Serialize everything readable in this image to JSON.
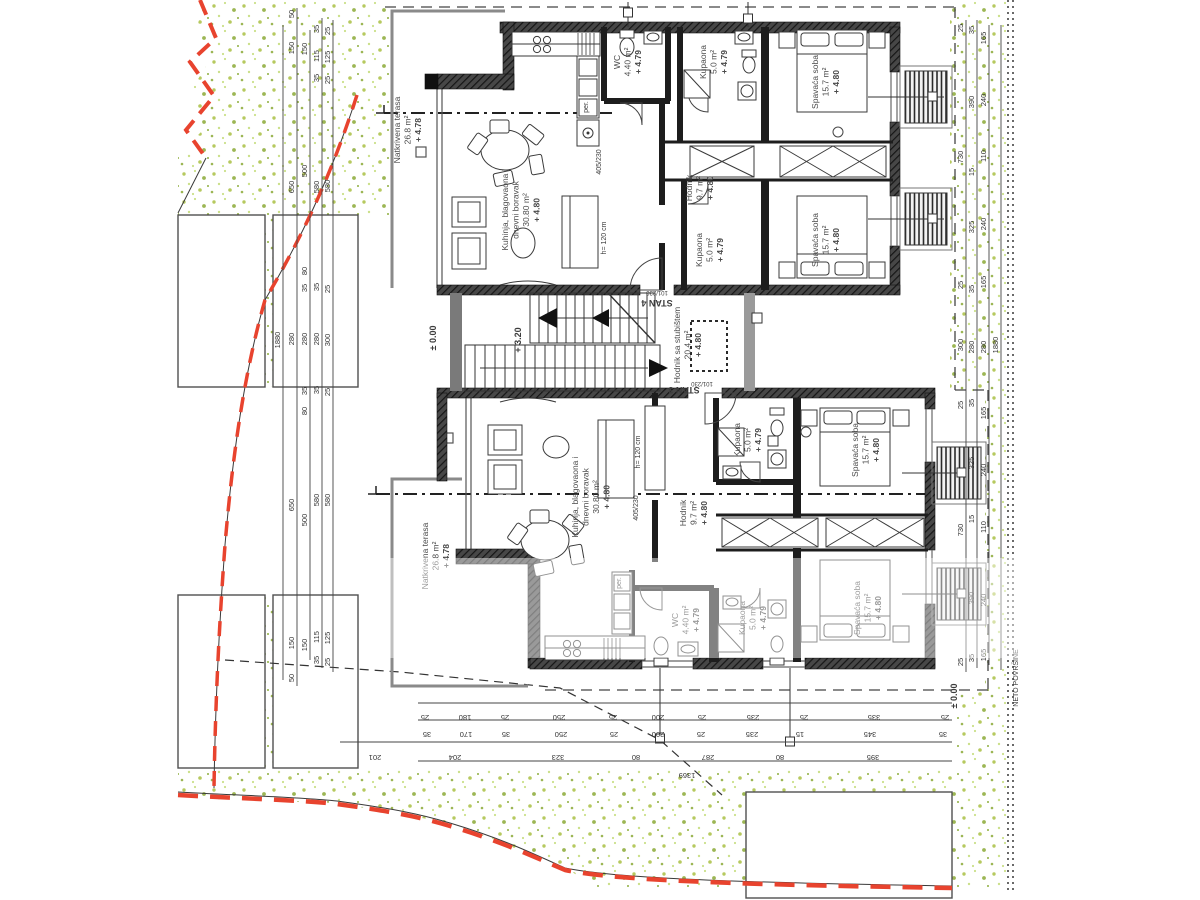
{
  "drawing": {
    "type": "architectural-floor-plan",
    "net_area_label": "NETO POVRŠINE",
    "boundary_color": "#e8432e",
    "grass_colors": [
      "#b6c95f",
      "#cbe08a",
      "#8fae3e"
    ]
  },
  "units": [
    {
      "id": "stan-4",
      "label": "STAN 4"
    },
    {
      "id": "stan-3",
      "label": "STAN 3"
    }
  ],
  "stan_labels": [
    {
      "text": "STAN 4",
      "x": 657,
      "y": 300
    },
    {
      "text": "STAN 3",
      "x": 684,
      "y": 387
    }
  ],
  "rooms": [
    {
      "lines": [
        "Natkrivena terasa",
        "26.8 m²",
        "+ 4.78"
      ],
      "x": 400,
      "y": 130
    },
    {
      "lines": [
        "Kuhinja, blagovaona i",
        "dnevni boravak",
        "30.80 m²",
        "+ 4.80"
      ],
      "x": 508,
      "y": 210
    },
    {
      "lines": [
        "WC",
        "4.40 m²",
        "+ 4.79"
      ],
      "x": 620,
      "y": 62
    },
    {
      "lines": [
        "Kupaona",
        "5.0 m²",
        "+ 4.79"
      ],
      "x": 706,
      "y": 62
    },
    {
      "lines": [
        "Spavaća soba",
        "15.7 m²",
        "+ 4.80"
      ],
      "x": 818,
      "y": 82
    },
    {
      "lines": [
        "Hodnik",
        "9.7 m²",
        "+ 4.80"
      ],
      "x": 692,
      "y": 188
    },
    {
      "lines": [
        "Kupaona",
        "5.0 m²",
        "+ 4.79"
      ],
      "x": 702,
      "y": 250
    },
    {
      "lines": [
        "Spavaća soba",
        "15.7 m²",
        "+ 4.80"
      ],
      "x": 818,
      "y": 240
    },
    {
      "lines": [
        "Hodnik sa stubištem",
        "20.4 m²",
        "+ 4.80"
      ],
      "x": 680,
      "y": 345
    },
    {
      "lines": [
        "Kupaona",
        "5.0 m²",
        "+ 4.79"
      ],
      "x": 740,
      "y": 440
    },
    {
      "lines": [
        "Spavaća soba",
        "15.7 m²",
        "+ 4.80"
      ],
      "x": 858,
      "y": 450
    },
    {
      "lines": [
        "Hodnik",
        "9.7 m²",
        "+ 4.80"
      ],
      "x": 686,
      "y": 513
    },
    {
      "lines": [
        "Kuhinja, blagovaona i",
        "dnevni boravak",
        "30.80 m²",
        "+ 4.80"
      ],
      "x": 578,
      "y": 497
    },
    {
      "lines": [
        "Natkrivena terasa",
        "26.8 m²",
        "+ 4.78"
      ],
      "x": 428,
      "y": 556
    },
    {
      "lines": [
        "WC",
        "4.40 m²",
        "+ 4.79"
      ],
      "x": 678,
      "y": 620
    },
    {
      "lines": [
        "Kupaona",
        "5.0 m²",
        "+ 4.79"
      ],
      "x": 745,
      "y": 618
    },
    {
      "lines": [
        "Spavaća soba",
        "15.7 m²",
        "+ 4.80"
      ],
      "x": 860,
      "y": 608
    }
  ],
  "levels": [
    {
      "text": "± 0.00",
      "x": 436,
      "y": 338
    },
    {
      "text": "+ 3.20",
      "x": 521,
      "y": 340
    },
    {
      "text": "± 0.00",
      "x": 957,
      "y": 696
    }
  ],
  "annotations": [
    {
      "text": "405/230",
      "x": 601,
      "y": 162,
      "rot": -90,
      "size": 7
    },
    {
      "text": "h= 120 cm",
      "x": 606,
      "y": 238,
      "rot": -90,
      "size": 7
    },
    {
      "text": "per.",
      "x": 588,
      "y": 107,
      "rot": -90,
      "size": 7
    },
    {
      "text": "405/230",
      "x": 638,
      "y": 508,
      "rot": -90,
      "size": 7
    },
    {
      "text": "h= 120 cm",
      "x": 640,
      "y": 452,
      "rot": -90,
      "size": 7
    },
    {
      "text": "per.",
      "x": 621,
      "y": 583,
      "rot": -90,
      "size": 7
    },
    {
      "text": "101/230",
      "x": 657,
      "y": 291,
      "rot": 180,
      "size": 6
    },
    {
      "text": "101/230",
      "x": 702,
      "y": 382,
      "rot": 180,
      "size": 6
    },
    {
      "text": "NETO POVRŠINE",
      "x": 1018,
      "y": 678,
      "rot": -90,
      "size": 7
    }
  ],
  "dims": {
    "left": [
      {
        "x": 283,
        "items": [
          {
            "v": "1880",
            "y": 340
          }
        ]
      },
      {
        "x": 297,
        "items": [
          {
            "v": "50",
            "y": 14
          },
          {
            "v": "150",
            "y": 48
          },
          {
            "v": "650",
            "y": 187
          },
          {
            "v": "280",
            "y": 339
          },
          {
            "v": "650",
            "y": 505
          },
          {
            "v": "150",
            "y": 643
          },
          {
            "v": "50",
            "y": 678
          }
        ]
      },
      {
        "x": 310,
        "items": [
          {
            "v": "150",
            "y": 49
          },
          {
            "v": "500",
            "y": 171
          },
          {
            "v": "80",
            "y": 271
          },
          {
            "v": "35",
            "y": 288
          },
          {
            "v": "280",
            "y": 339
          },
          {
            "v": "35",
            "y": 391
          },
          {
            "v": "80",
            "y": 411
          },
          {
            "v": "500",
            "y": 520
          },
          {
            "v": "150",
            "y": 645
          }
        ]
      },
      {
        "x": 322,
        "items": [
          {
            "v": "35",
            "y": 29
          },
          {
            "v": "115",
            "y": 56
          },
          {
            "v": "35",
            "y": 78
          },
          {
            "v": "580",
            "y": 187
          },
          {
            "v": "35",
            "y": 287
          },
          {
            "v": "280",
            "y": 339
          },
          {
            "v": "35",
            "y": 390
          },
          {
            "v": "580",
            "y": 500
          },
          {
            "v": "115",
            "y": 637
          },
          {
            "v": "35",
            "y": 660
          }
        ]
      },
      {
        "x": 333,
        "items": [
          {
            "v": "25",
            "y": 31
          },
          {
            "v": "125",
            "y": 57
          },
          {
            "v": "25",
            "y": 80
          },
          {
            "v": "580",
            "y": 186
          },
          {
            "v": "25",
            "y": 289
          },
          {
            "v": "300",
            "y": 340
          },
          {
            "v": "25",
            "y": 392
          },
          {
            "v": "580",
            "y": 500
          },
          {
            "v": "125",
            "y": 638
          },
          {
            "v": "25",
            "y": 662
          }
        ]
      }
    ],
    "right": [
      {
        "x": 966,
        "items": [
          {
            "v": "25",
            "y": 28
          },
          {
            "v": "730",
            "y": 157
          },
          {
            "v": "25",
            "y": 285
          },
          {
            "v": "300",
            "y": 345
          },
          {
            "v": "25",
            "y": 405
          },
          {
            "v": "730",
            "y": 530
          },
          {
            "v": "25",
            "y": 662
          }
        ]
      },
      {
        "x": 977,
        "items": [
          {
            "v": "35",
            "y": 30
          },
          {
            "v": "390",
            "y": 102
          },
          {
            "v": "15",
            "y": 172
          },
          {
            "v": "325",
            "y": 227
          },
          {
            "v": "35",
            "y": 289
          },
          {
            "v": "280",
            "y": 347
          },
          {
            "v": "35",
            "y": 403
          },
          {
            "v": "325",
            "y": 463
          },
          {
            "v": "15",
            "y": 519
          },
          {
            "v": "390",
            "y": 598
          },
          {
            "v": "35",
            "y": 658
          }
        ]
      },
      {
        "x": 989,
        "items": [
          {
            "v": "165",
            "y": 38
          },
          {
            "v": "240",
            "y": 100
          },
          {
            "v": "110",
            "y": 156
          },
          {
            "v": "240",
            "y": 224
          },
          {
            "v": "165",
            "y": 282
          },
          {
            "v": "280",
            "y": 347
          },
          {
            "v": "165",
            "y": 413
          },
          {
            "v": "240",
            "y": 470
          },
          {
            "v": "110",
            "y": 527
          },
          {
            "v": "240",
            "y": 600
          },
          {
            "v": "165",
            "y": 655
          }
        ]
      },
      {
        "x": 1001,
        "items": [
          {
            "v": "1880",
            "y": 345
          }
        ]
      }
    ],
    "bottom": [
      {
        "y": 706,
        "items": [
          {
            "v": "25",
            "x": 425
          },
          {
            "v": "180",
            "x": 465
          },
          {
            "v": "25",
            "x": 505
          },
          {
            "v": "250",
            "x": 559
          },
          {
            "v": "25",
            "x": 613
          },
          {
            "v": "200",
            "x": 658
          },
          {
            "v": "25",
            "x": 702
          },
          {
            "v": "235",
            "x": 753
          },
          {
            "v": "25",
            "x": 804
          },
          {
            "v": "335",
            "x": 874
          },
          {
            "v": "25",
            "x": 945
          }
        ]
      },
      {
        "y": 723,
        "items": [
          {
            "v": "35",
            "x": 427
          },
          {
            "v": "170",
            "x": 466
          },
          {
            "v": "35",
            "x": 506
          },
          {
            "v": "250",
            "x": 561
          },
          {
            "v": "25",
            "x": 614
          },
          {
            "v": "200",
            "x": 658
          },
          {
            "v": "25",
            "x": 701
          },
          {
            "v": "235",
            "x": 752
          },
          {
            "v": "15",
            "x": 800
          },
          {
            "v": "345",
            "x": 870
          },
          {
            "v": "35",
            "x": 943
          }
        ]
      },
      {
        "y": 746,
        "items": [
          {
            "v": "201",
            "x": 375
          },
          {
            "v": "204",
            "x": 455
          },
          {
            "v": "323",
            "x": 558
          },
          {
            "v": "80",
            "x": 636
          },
          {
            "v": "287",
            "x": 708
          },
          {
            "v": "80",
            "x": 780
          },
          {
            "v": "395",
            "x": 873
          }
        ]
      },
      {
        "y": 764,
        "items": [
          {
            "v": "1369",
            "x": 687
          }
        ]
      }
    ]
  }
}
